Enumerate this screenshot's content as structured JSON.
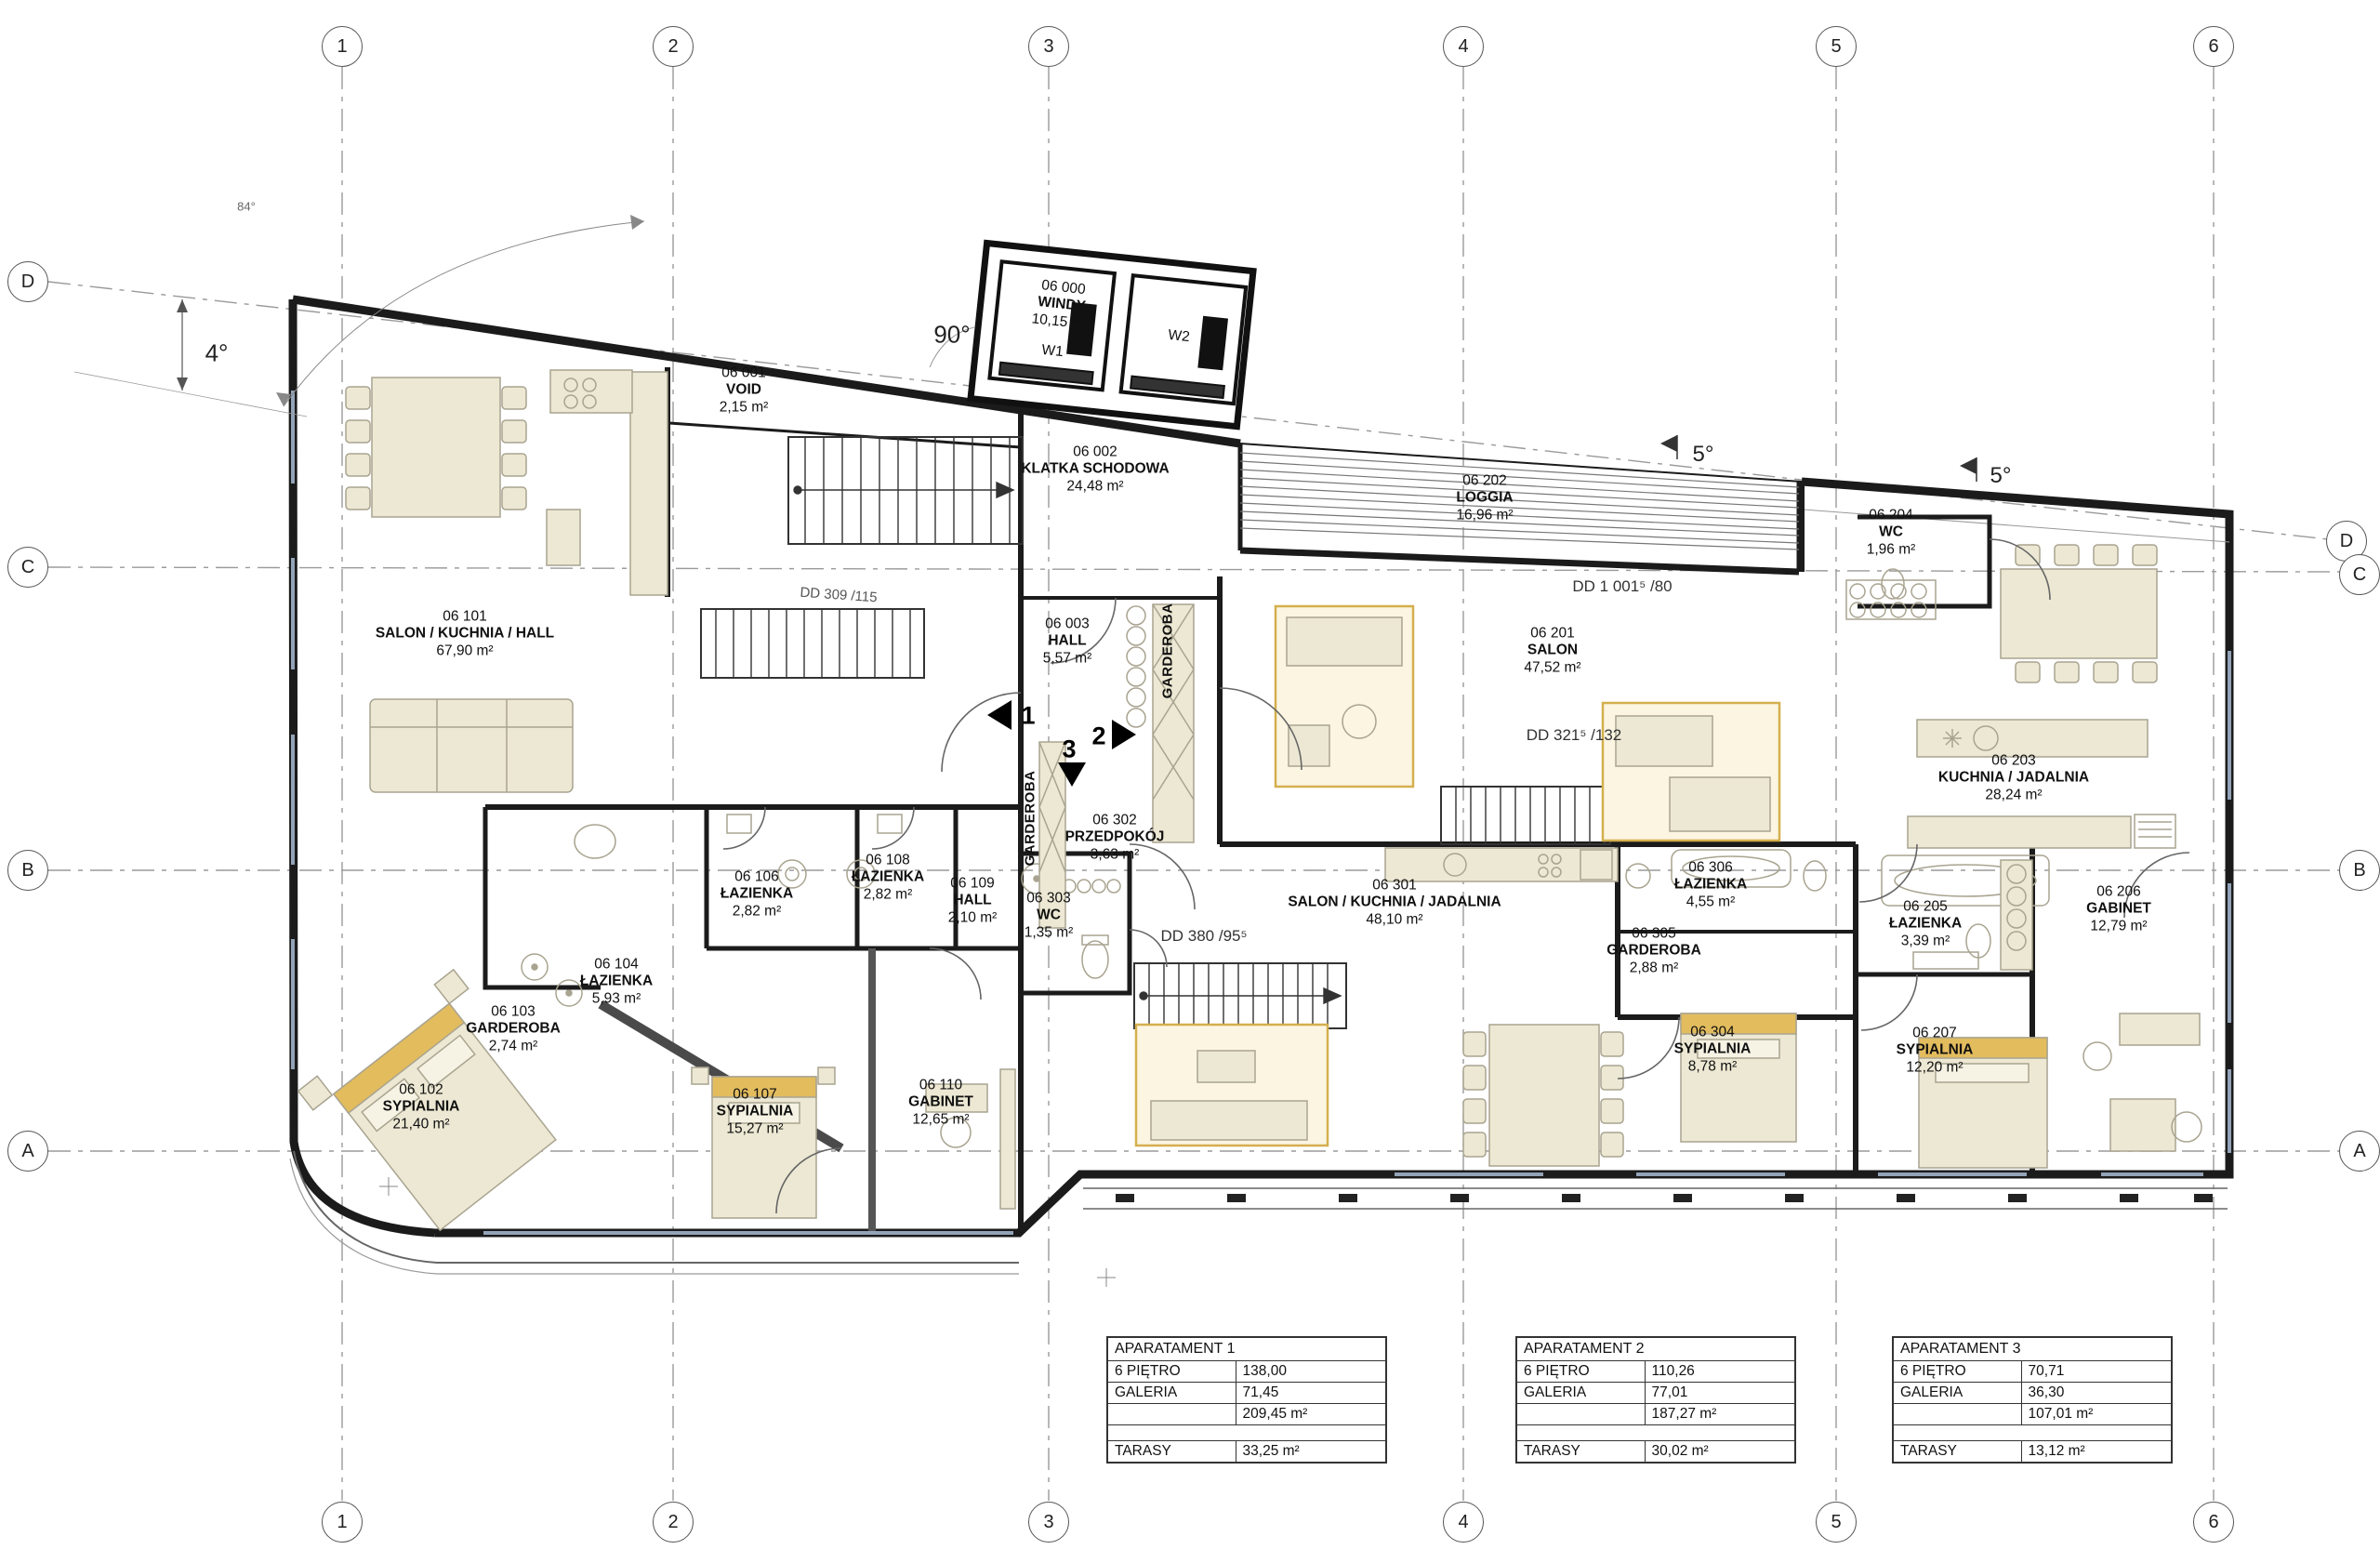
{
  "grid": {
    "columns": [
      "1",
      "2",
      "3",
      "4",
      "5",
      "6"
    ],
    "rows": [
      "D",
      "C",
      "B",
      "A"
    ]
  },
  "rooms": [
    {
      "number": "06 000",
      "name": "WINDY",
      "area": "10,15 m²"
    },
    {
      "number": "06 001",
      "name": "VOID",
      "area": "2,15 m²"
    },
    {
      "number": "06 002",
      "name": "KLATKA SCHODOWA",
      "area": "24,48 m²"
    },
    {
      "number": "06 003",
      "name": "HALL",
      "area": "5,57 m²"
    },
    {
      "number": "06 101",
      "name": "SALON / KUCHNIA / HALL",
      "area": "67,90 m²"
    },
    {
      "number": "06 102",
      "name": "SYPIALNIA",
      "area": "21,40 m²"
    },
    {
      "number": "06 103",
      "name": "GARDEROBA",
      "area": "2,74 m²"
    },
    {
      "number": "06 104",
      "name": "ŁAZIENKA",
      "area": "5,93 m²"
    },
    {
      "number": "06 106",
      "name": "ŁAZIENKA",
      "area": "2,82 m²"
    },
    {
      "number": "06 107",
      "name": "SYPIALNIA",
      "area": "15,27 m²"
    },
    {
      "number": "06 108",
      "name": "ŁAZIENKA",
      "area": "2,82 m²"
    },
    {
      "number": "06 109",
      "name": "HALL",
      "area": "2,10 m²"
    },
    {
      "number": "06 110",
      "name": "GABINET",
      "area": "12,65 m²"
    },
    {
      "number": "06 201",
      "name": "SALON",
      "area": "47,52 m²"
    },
    {
      "number": "06 202",
      "name": "LOGGIA",
      "area": "16,96 m²"
    },
    {
      "number": "06 203",
      "name": "KUCHNIA / JADALNIA",
      "area": "28,24 m²"
    },
    {
      "number": "06 204",
      "name": "WC",
      "area": "1,96 m²"
    },
    {
      "number": "06 205",
      "name": "ŁAZIENKA",
      "area": "3,39 m²"
    },
    {
      "number": "06 206",
      "name": "GABINET",
      "area": "12,79 m²"
    },
    {
      "number": "06 207",
      "name": "SYPIALNIA",
      "area": "12,20 m²"
    },
    {
      "number": "06 301",
      "name": "SALON / KUCHNIA / JADALNIA",
      "area": "48,10 m²"
    },
    {
      "number": "06 302",
      "name": "PRZEDPOKÓJ",
      "area": "3,63 m²"
    },
    {
      "number": "06 303",
      "name": "WC",
      "area": "1,35 m²"
    },
    {
      "number": "06 304",
      "name": "SYPIALNIA",
      "area": "8,78 m²"
    },
    {
      "number": "06 305",
      "name": "GARDEROBA",
      "area": "2,88 m²"
    },
    {
      "number": "06 306",
      "name": "ŁAZIENKA",
      "area": "4,55 m²"
    }
  ],
  "elevator": {
    "w1": "W1",
    "w2": "W2"
  },
  "labels": {
    "garderoba_vertical": "GARDEROBA"
  },
  "annotations": {
    "angle_84": "84°",
    "angle_4": "4°",
    "angle_90": "90°",
    "angle_5a": "5°",
    "angle_5b": "5°",
    "dd_loggia": "DD 1 001⁵ /80",
    "dd_stair2": "DD 321⁵ /132",
    "dd_stair3": "DD 380 /95⁵",
    "dd_wall": "DD 309 /115",
    "section_1": "1",
    "section_2": "2",
    "section_3": "3"
  },
  "tables": [
    {
      "title": "APARATAMENT 1",
      "rows": [
        [
          "6 PIĘTRO",
          "138,00"
        ],
        [
          "GALERIA",
          "71,45"
        ],
        [
          "",
          "209,45 m²"
        ]
      ],
      "terrace": [
        "TARASY",
        "33,25 m²"
      ]
    },
    {
      "title": "APARATAMENT 2",
      "rows": [
        [
          "6 PIĘTRO",
          "110,26"
        ],
        [
          "GALERIA",
          "77,01"
        ],
        [
          "",
          "187,27 m²"
        ]
      ],
      "terrace": [
        "TARASY",
        "30,02 m²"
      ]
    },
    {
      "title": "APARATAMENT 3",
      "rows": [
        [
          "6 PIĘTRO",
          "70,71"
        ],
        [
          "GALERIA",
          "36,30"
        ],
        [
          "",
          "107,01 m²"
        ]
      ],
      "terrace": [
        "TARASY",
        "13,12 m²"
      ]
    }
  ],
  "colors": {
    "wall": "#1b1b1b",
    "furniture_fill": "#ece8d3",
    "accent_gold": "#ddb457",
    "hatch": "#777777",
    "window": "#93a3b8"
  }
}
